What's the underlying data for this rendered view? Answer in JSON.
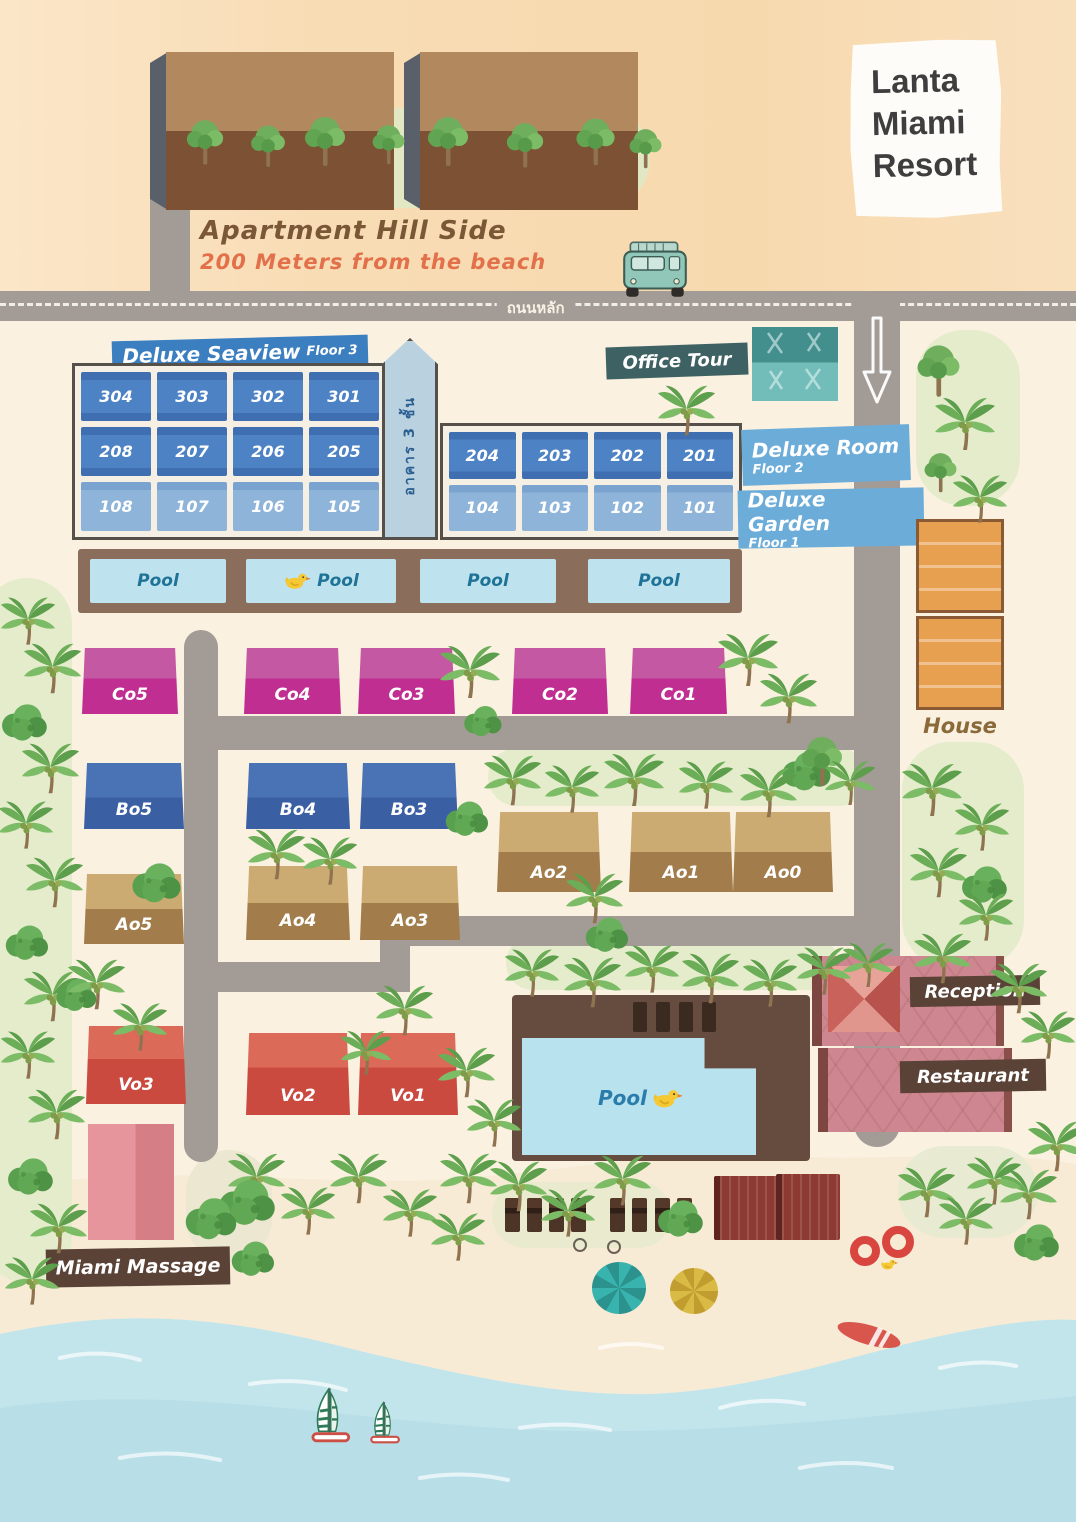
{
  "title": {
    "line1": "Lanta",
    "line2": "Miami",
    "line3": "Resort"
  },
  "hillside": {
    "name": "Apartment Hill Side",
    "distance": "200 Meters from the beach"
  },
  "road": {
    "thai_label": "ถนนหลัก"
  },
  "seaview": {
    "banner": "Deluxe Seaview",
    "banner_floor": "Floor 3",
    "tower_thai": "อาคาร 3 ชั้น",
    "rooms_f3_left": [
      "304",
      "303",
      "302",
      "301"
    ],
    "rooms_f2_left": [
      "208",
      "207",
      "206",
      "205"
    ],
    "rooms_f1_left": [
      "108",
      "107",
      "106",
      "105"
    ],
    "rooms_f2_right": [
      "204",
      "203",
      "202",
      "201"
    ],
    "rooms_f1_right": [
      "104",
      "103",
      "102",
      "101"
    ]
  },
  "office_tour": {
    "label": "Office Tour"
  },
  "deluxe_room": {
    "title": "Deluxe Room",
    "floor": "Floor 2"
  },
  "deluxe_garden": {
    "title": "Deluxe Garden",
    "floor": "Floor 1"
  },
  "pool_row": [
    "Pool",
    "Pool",
    "Pool",
    "Pool"
  ],
  "main_pool": {
    "label": "Pool"
  },
  "cottages": {
    "c_row": [
      "Co5",
      "Co4",
      "Co3",
      "Co2",
      "Co1"
    ],
    "b_row": [
      "Bo5",
      "Bo4",
      "Bo3"
    ],
    "a_upper": [
      "Ao2",
      "Ao1",
      "Ao0"
    ],
    "a_lower": [
      "Ao5",
      "Ao4",
      "Ao3"
    ],
    "v_single": "Vo3",
    "v_row": [
      "Vo2",
      "Vo1"
    ]
  },
  "facilities": {
    "reception": "Reception",
    "restaurant": "Restaurant",
    "house": "House",
    "massage": "Miami Massage"
  },
  "colors": {
    "banner_blue": "#3b7fc0",
    "banner_teal": "#3e6263",
    "banner_brown": "#5a4236",
    "magenta": "#c02e91",
    "royal_blue": "#3a5fa2",
    "tan": "#a27d4b",
    "coral": "#cb4a40",
    "rose": "#ce8790",
    "orange": "#e6a050",
    "road_gray": "#a39b95",
    "ocean": "#c2e5ec"
  }
}
